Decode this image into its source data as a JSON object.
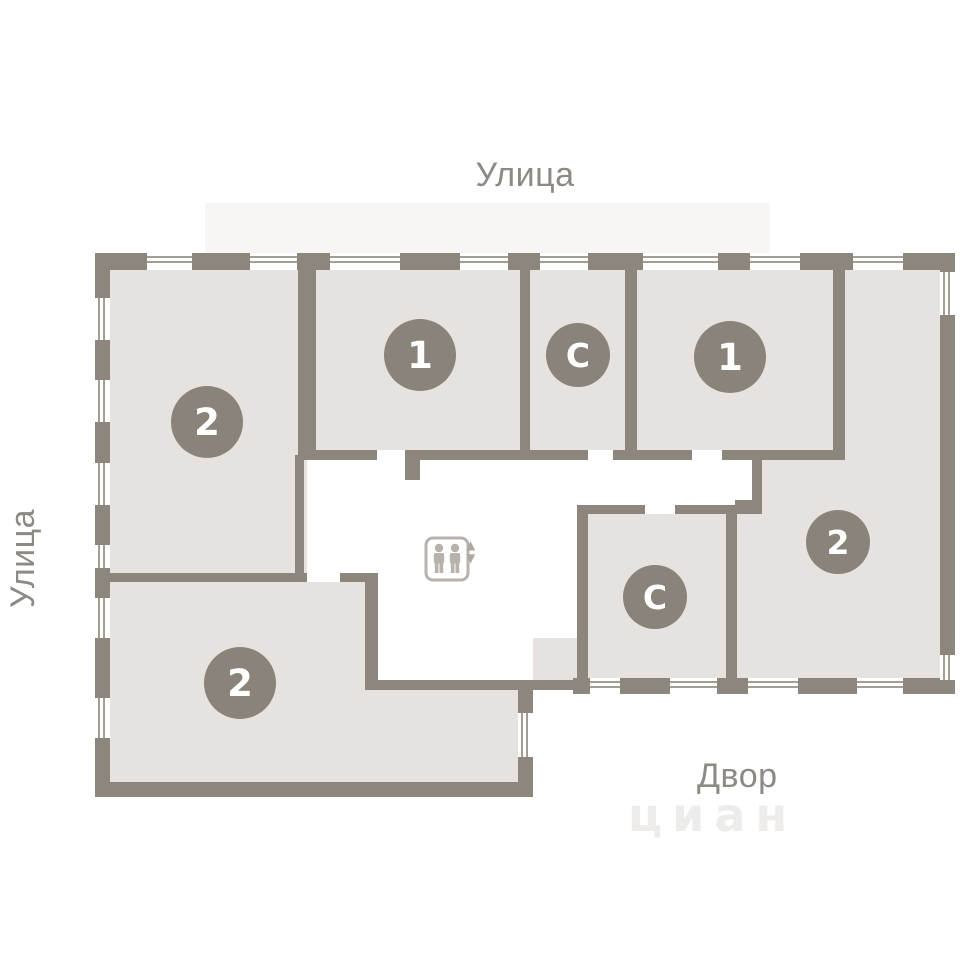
{
  "labels": {
    "street_top": "Улица",
    "street_left": "Улица",
    "courtyard": "Двор"
  },
  "watermark": {
    "text": "циан"
  },
  "rooms": [
    {
      "name": "two-room-top-left",
      "badge": "2"
    },
    {
      "name": "one-room-left",
      "badge": "1"
    },
    {
      "name": "studio-top",
      "badge": "С"
    },
    {
      "name": "one-room-right",
      "badge": "1"
    },
    {
      "name": "two-room-right",
      "badge": "2"
    },
    {
      "name": "studio-bottom",
      "badge": "С"
    },
    {
      "name": "two-room-bottom-left",
      "badge": "2"
    }
  ],
  "elevator": {
    "up_arrow": "▲",
    "down_arrow": "▼"
  },
  "colors": {
    "wall": "#8d867c",
    "room_fill": "#e6e2df",
    "badge": "#8a837a",
    "badge_text": "#ffffff",
    "label_text": "#8d8983",
    "elevator_icon": "#b8b2ac",
    "background": "#ffffff"
  }
}
